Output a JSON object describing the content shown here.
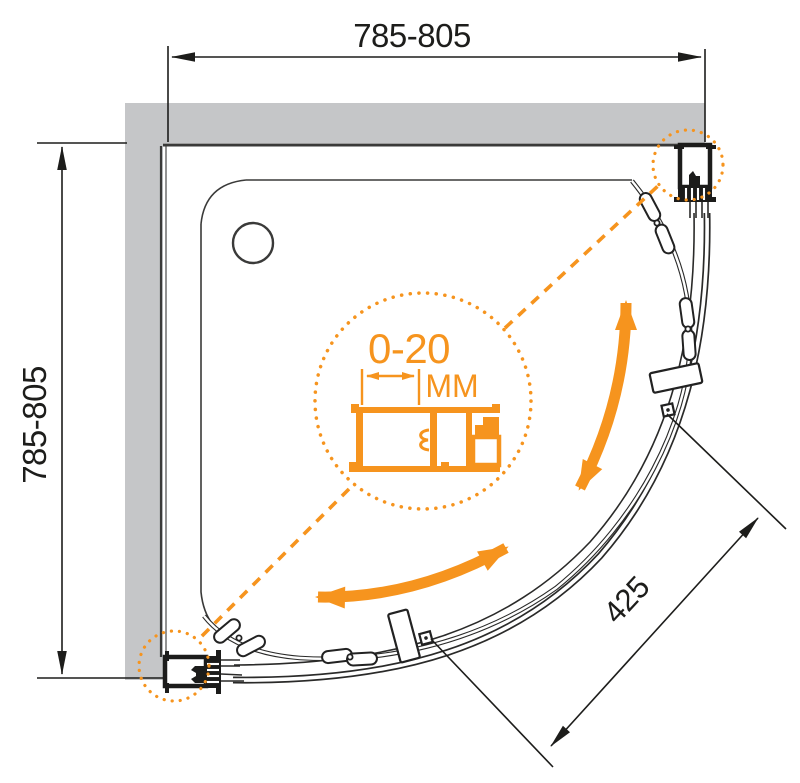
{
  "diagram": {
    "title": "quarter-round shower enclosure plan drawing",
    "dimensions": {
      "width_label": "785-805",
      "height_label": "785-805",
      "radius_label": "425",
      "adjustment_range": "0-20",
      "adjustment_unit": "MM"
    },
    "colors": {
      "accent_orange": "#F6941E",
      "wall_gray": "#C5C6C8",
      "line_dark": "#1D1D1B"
    }
  }
}
